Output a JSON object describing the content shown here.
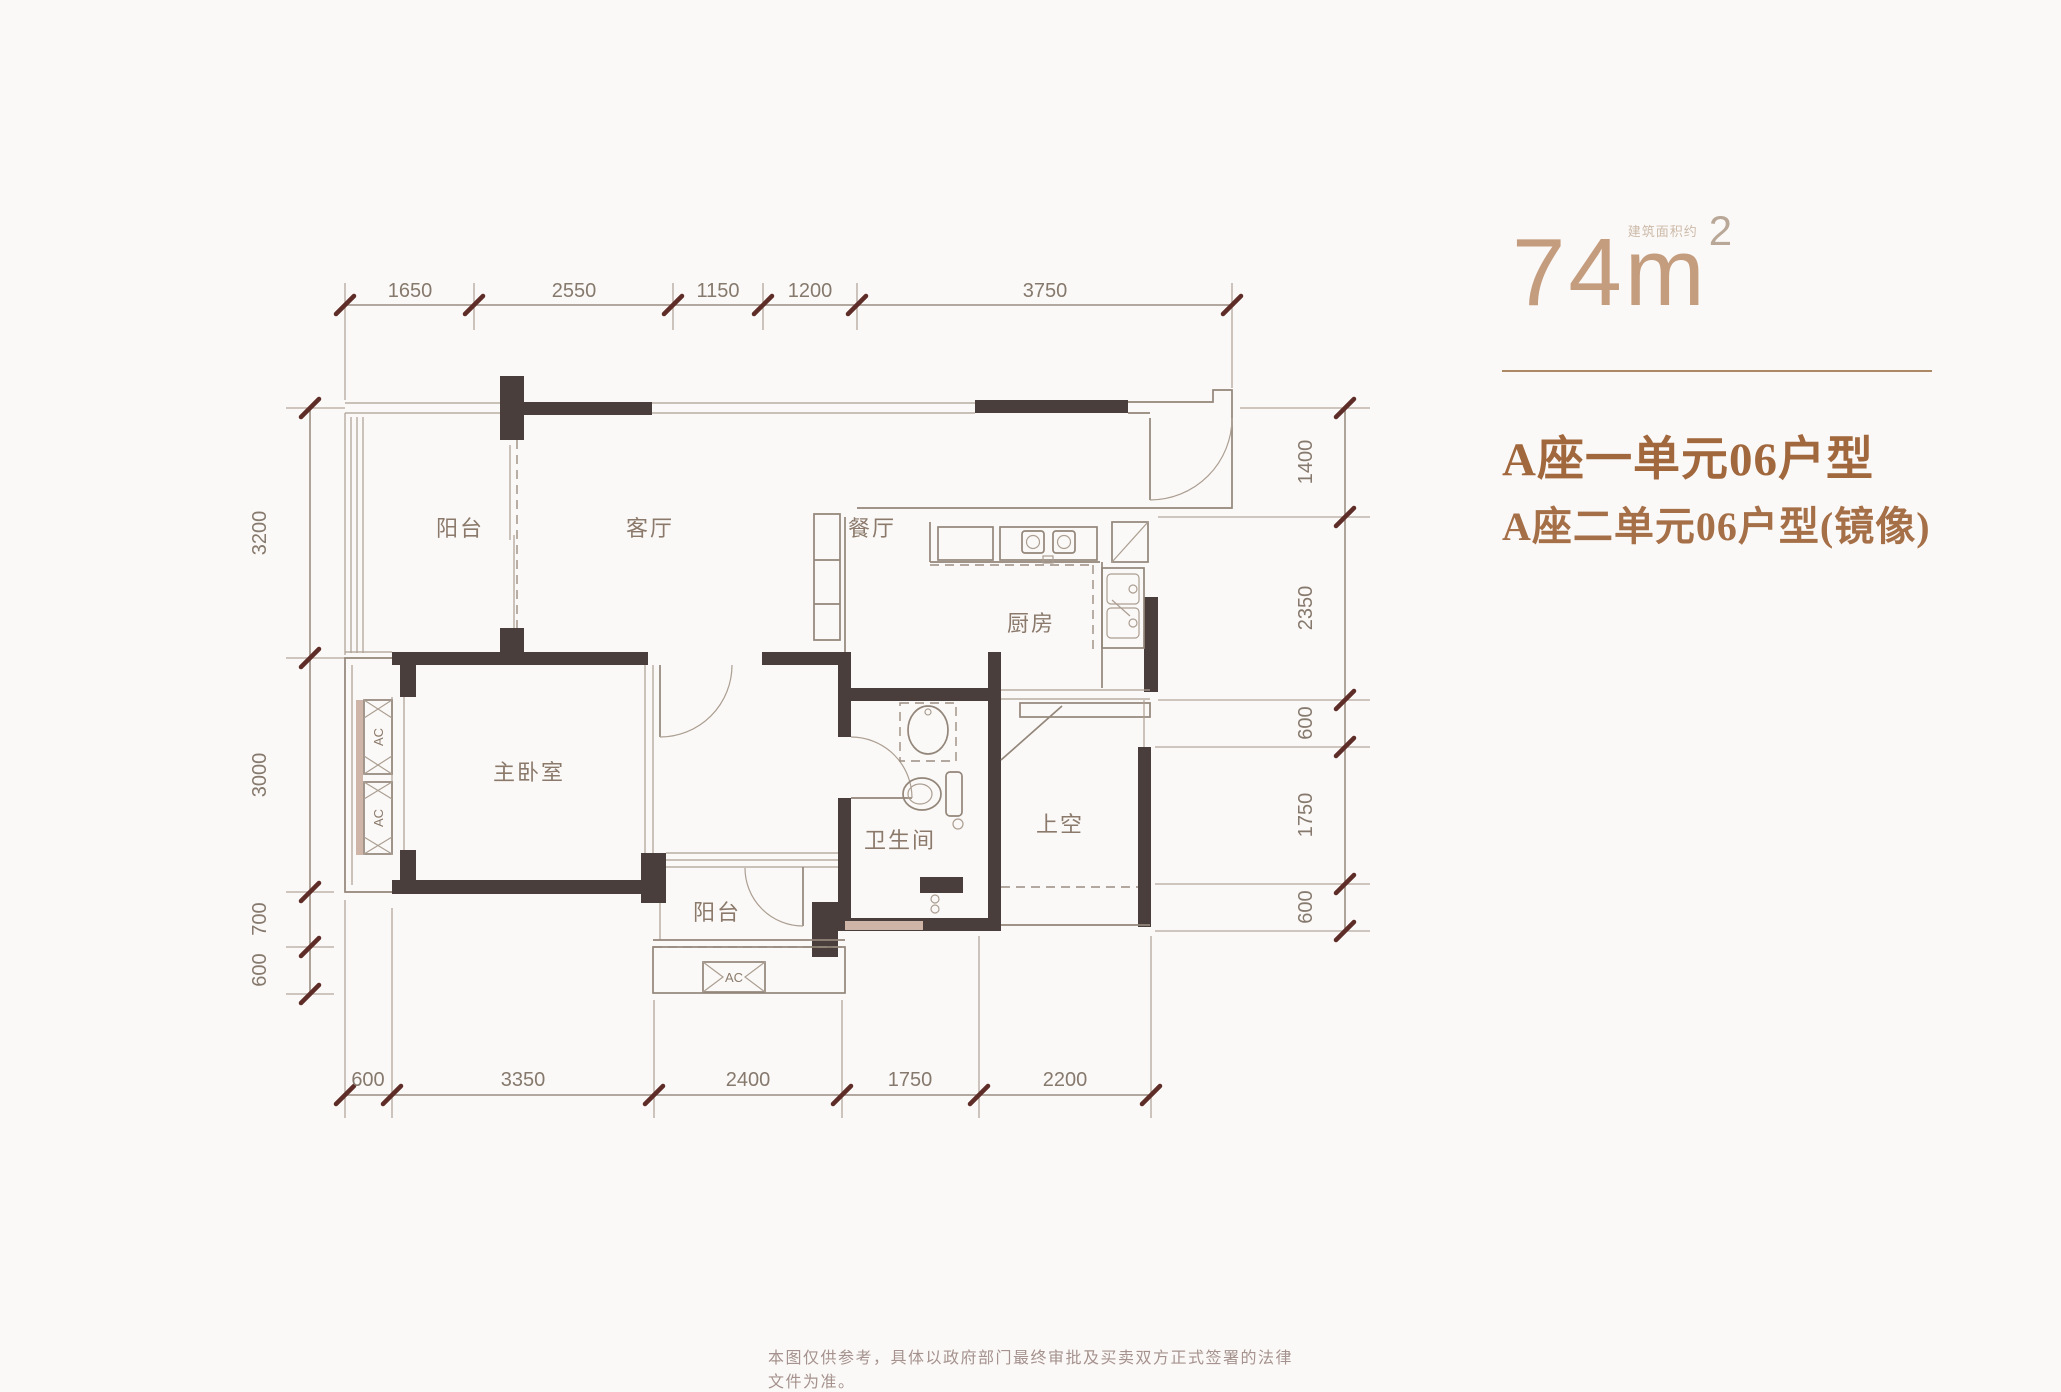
{
  "page": {
    "disclaimer": "本图仅供参考，具体以政府部门最终审批及买卖双方正式签署的法律文件为准。"
  },
  "title": {
    "area_number": "74",
    "area_unit": "m",
    "area_superscript": "2",
    "area_note": "建筑面积约",
    "line1": "A座一单元06户型",
    "line2": "A座二单元06户型(镜像)"
  },
  "rooms": {
    "balcony_top": "阳台",
    "living": "客厅",
    "dining": "餐厅",
    "kitchen": "厨房",
    "master_bedroom": "主卧室",
    "bathroom": "卫生间",
    "void": "上空",
    "balcony_bottom": "阳台",
    "ac": "AC"
  },
  "dimensions": {
    "top": [
      "1650",
      "2550",
      "1150",
      "1200",
      "3750"
    ],
    "bottom": [
      "600",
      "3350",
      "2400",
      "1750",
      "2200"
    ],
    "left": [
      "3200",
      "3000",
      "700",
      "600"
    ],
    "right": [
      "1400",
      "2350",
      "600",
      "1750",
      "600"
    ]
  },
  "colors": {
    "wall": "#4a3e3d",
    "accent_title": "#c49c7e",
    "accent_subtitle": "#a1673d",
    "tick": "#5e2d28"
  }
}
